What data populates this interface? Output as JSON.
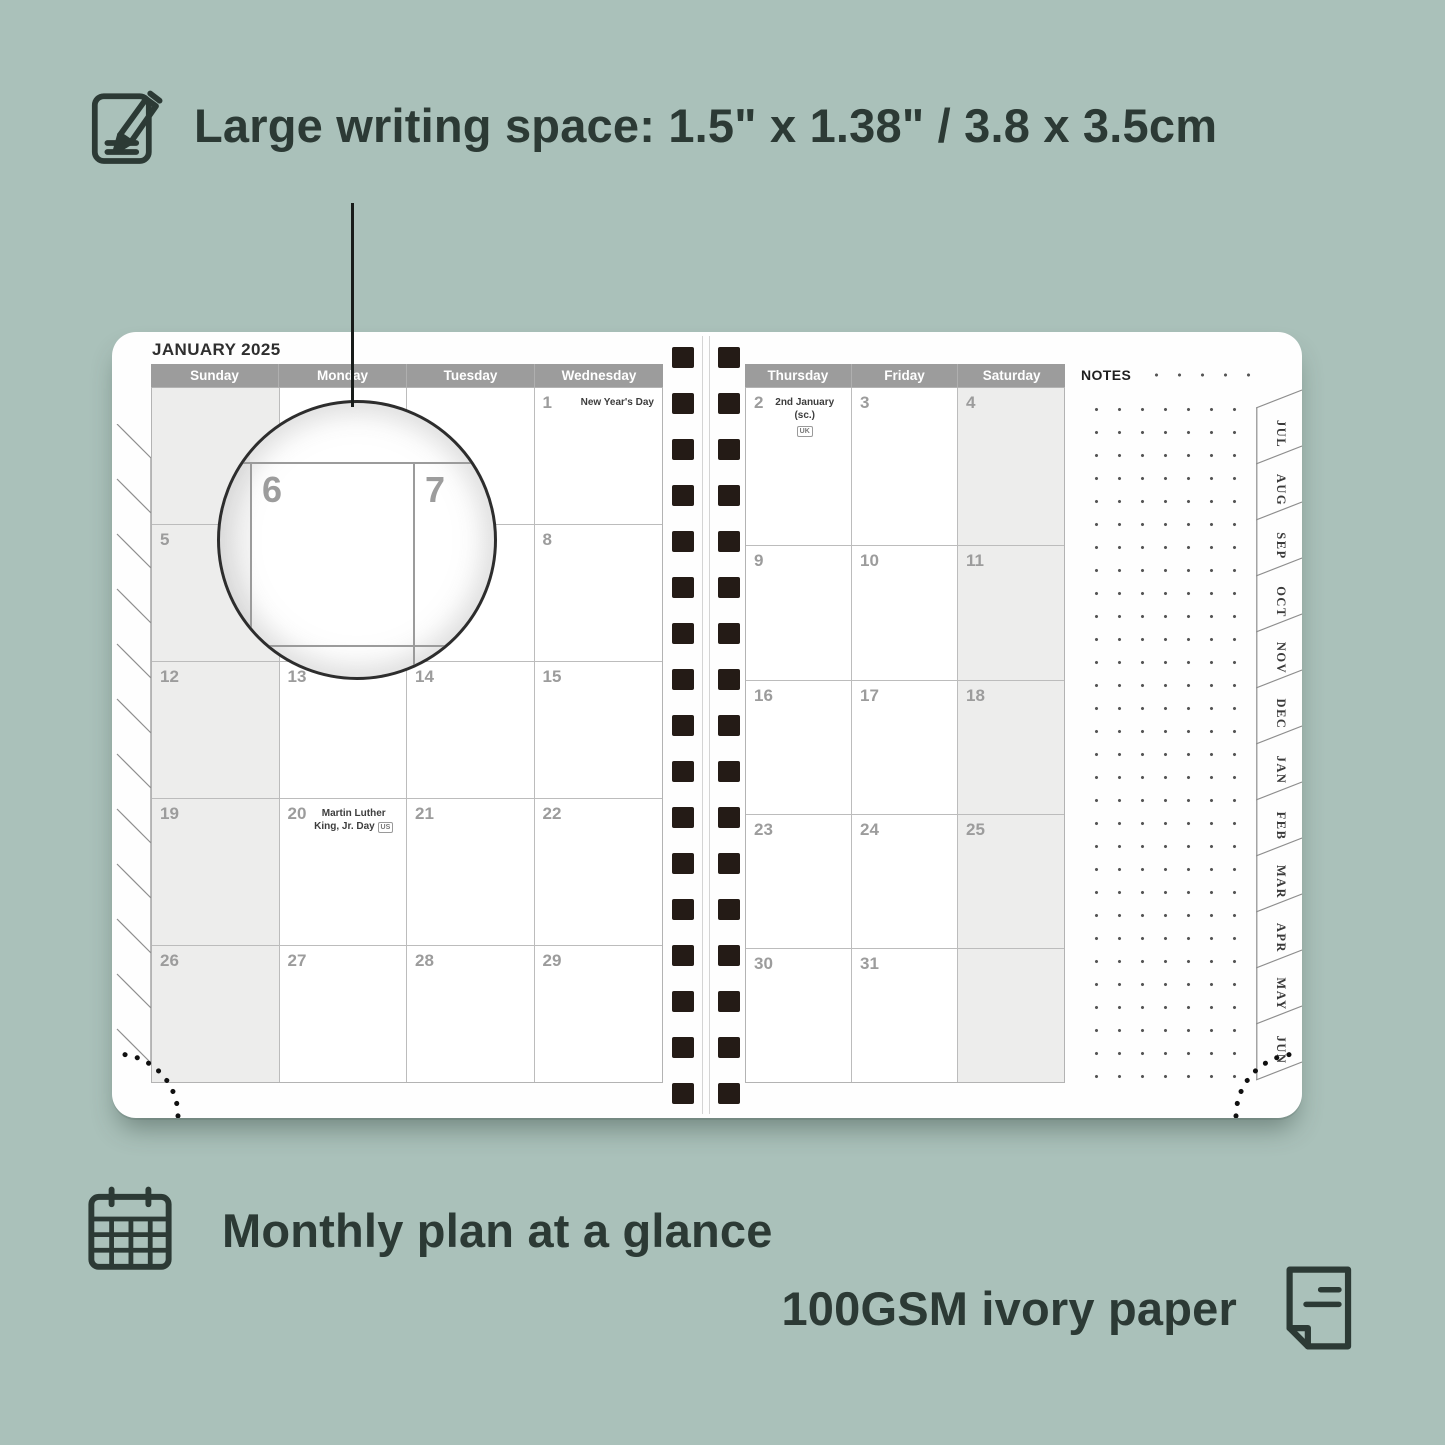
{
  "colors": {
    "background": "#aac1ba",
    "ink": "#2c3a35",
    "header_bar": "#9c9c9c",
    "weekend_fill": "#ededec",
    "grid_line": "#b3b3b3",
    "date_number": "#9c9c9c",
    "spiral_hole": "#241b16"
  },
  "hero": {
    "icon": "pencil-note-icon",
    "title": "Large writing space: 1.5\" x 1.38\" / 3.8 x 3.5cm"
  },
  "planner": {
    "month_tabs": [
      "JUL",
      "AUG",
      "SEP",
      "OCT",
      "NOV",
      "DEC",
      "JAN",
      "FEB",
      "MAR",
      "APR",
      "MAY",
      "JUN"
    ],
    "left_page": {
      "month_title": "JANUARY 2025",
      "day_headers": [
        "Sunday",
        "Monday",
        "Tuesday",
        "Wednesday"
      ],
      "shaded_column": 0,
      "weeks": [
        [
          null,
          null,
          null,
          {
            "d": "1",
            "holiday": "New Year's Day"
          }
        ],
        [
          {
            "d": "5"
          },
          {
            "d": "6"
          },
          {
            "d": "7"
          },
          {
            "d": "8"
          }
        ],
        [
          {
            "d": "12"
          },
          {
            "d": "13"
          },
          {
            "d": "14"
          },
          {
            "d": "15"
          }
        ],
        [
          {
            "d": "19"
          },
          {
            "d": "20",
            "holiday": "Martin Luther King, Jr. Day",
            "badge": "US",
            "badge_below": false
          },
          {
            "d": "21"
          },
          {
            "d": "22"
          }
        ],
        [
          {
            "d": "26"
          },
          {
            "d": "27"
          },
          {
            "d": "28"
          },
          {
            "d": "29"
          }
        ]
      ]
    },
    "right_page": {
      "day_headers": [
        "Thursday",
        "Friday",
        "Saturday"
      ],
      "shaded_column": 2,
      "notes_label": "NOTES",
      "weeks": [
        [
          {
            "d": "2",
            "holiday": "2nd January (sc.)",
            "badge": "UK",
            "badge_below": true
          },
          {
            "d": "3"
          },
          {
            "d": "4"
          }
        ],
        [
          {
            "d": "9"
          },
          {
            "d": "10"
          },
          {
            "d": "11"
          }
        ],
        [
          {
            "d": "16"
          },
          {
            "d": "17"
          },
          {
            "d": "18"
          }
        ],
        [
          {
            "d": "23"
          },
          {
            "d": "24"
          },
          {
            "d": "25"
          }
        ],
        [
          {
            "d": "30"
          },
          {
            "d": "31"
          },
          null
        ]
      ]
    }
  },
  "magnifier": {
    "days": [
      "6",
      "7"
    ]
  },
  "footer": {
    "line1_icon": "calendar-grid-icon",
    "line1": "Monthly plan at a glance",
    "line2": "100GSM ivory paper",
    "line2_icon": "paper-sheet-icon"
  }
}
